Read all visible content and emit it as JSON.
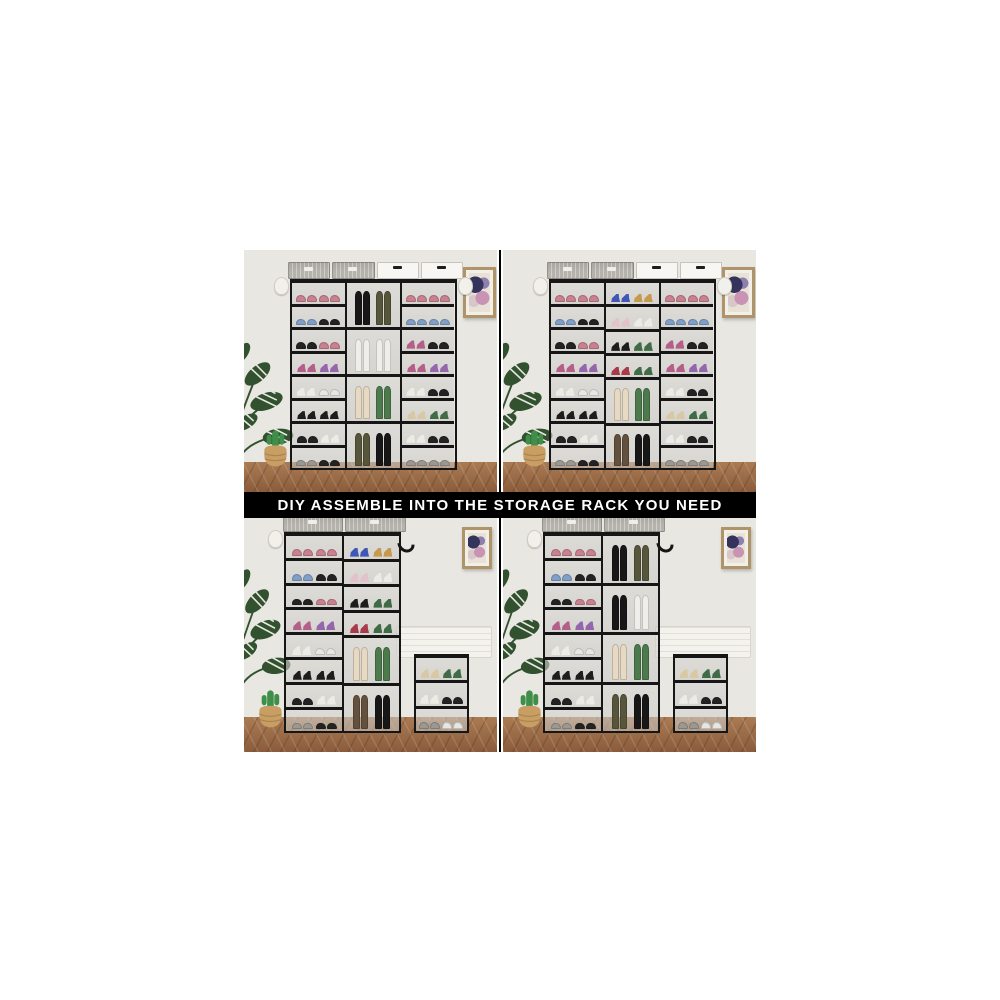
{
  "image": {
    "description": "e-commerce product collage of DIY modular shoe storage racks shown in four room scenes",
    "background": "#ffffff"
  },
  "banner": {
    "text": "DIY ASSEMBLE INTO THE STORAGE RACK YOU NEED",
    "bg": "#000000",
    "color": "#ffffff"
  },
  "colors": {
    "wall": "#e9e7e2",
    "floor_light": "#aa7b53",
    "floor_dark": "#8a5c3c",
    "rack_frame": "#161616",
    "shelf_back": "#cdccc8",
    "basket_gray": "#b6b3ad",
    "basket_white": "#f7f6f2",
    "frame_wood": "#ae9468",
    "bench_white": "#f4f2ed",
    "plant_green": "#31512f",
    "cactus_green": "#3f8f4b",
    "pot_tan": "#c89e62",
    "divider": "#000000"
  },
  "palette": {
    "pk": {
      "type": "sneaker",
      "color": "#c9808f"
    },
    "bl": {
      "type": "sneaker",
      "color": "#7f9fc9"
    },
    "wh": {
      "type": "sneaker",
      "color": "#e6e6e3"
    },
    "gy": {
      "type": "sneaker",
      "color": "#9a9893"
    },
    "bk": {
      "type": "sneaker",
      "color": "#232323"
    },
    "ph": {
      "type": "heel",
      "color": "#9467ad"
    },
    "mh": {
      "type": "heel",
      "color": "#b35f8a"
    },
    "whh": {
      "type": "heel",
      "color": "#edebe6"
    },
    "bh": {
      "type": "heel",
      "color": "#1d1d1d"
    },
    "rh": {
      "type": "heel",
      "color": "#a93a4a"
    },
    "yh": {
      "type": "heel",
      "color": "#c59a4e"
    },
    "blh": {
      "type": "heel",
      "color": "#4157b8"
    },
    "gh": {
      "type": "heel",
      "color": "#3f6b46"
    },
    "pf": {
      "type": "heel",
      "color": "#e2c3c9"
    },
    "th": {
      "type": "heel",
      "color": "#d8c9a4"
    },
    "bb": {
      "type": "boot",
      "color": "#171717"
    },
    "ob": {
      "type": "boot",
      "color": "#57563b"
    },
    "wb": {
      "type": "boot",
      "color": "#efeeea"
    },
    "cb": {
      "type": "boot",
      "color": "#e7d9c2"
    },
    "grb": {
      "type": "boot",
      "color": "#4c7a4c"
    },
    "brb": {
      "type": "boot",
      "color": "#63503d"
    }
  },
  "columns": {
    "sideA": [
      {
        "h": 1,
        "shoes": [
          "pk",
          "pk"
        ]
      },
      {
        "h": 1,
        "shoes": [
          "bl",
          "bk"
        ]
      },
      {
        "h": 1,
        "shoes": [
          "bk",
          "pk"
        ]
      },
      {
        "h": 1,
        "shoes": [
          "mh",
          "ph"
        ]
      },
      {
        "h": 1,
        "shoes": [
          "whh",
          "wh"
        ]
      },
      {
        "h": 1,
        "shoes": [
          "bh",
          "bh"
        ]
      },
      {
        "h": 1,
        "shoes": [
          "bk",
          "whh"
        ]
      },
      {
        "h": 1,
        "shoes": [
          "gy",
          "bk"
        ]
      }
    ],
    "sideB": [
      {
        "h": 1,
        "shoes": [
          "pk",
          "pk"
        ]
      },
      {
        "h": 1,
        "shoes": [
          "bl",
          "bl"
        ]
      },
      {
        "h": 1,
        "shoes": [
          "mh",
          "bk"
        ]
      },
      {
        "h": 1,
        "shoes": [
          "mh",
          "ph"
        ]
      },
      {
        "h": 1,
        "shoes": [
          "whh",
          "bk"
        ]
      },
      {
        "h": 1,
        "shoes": [
          "th",
          "gh"
        ]
      },
      {
        "h": 1,
        "shoes": [
          "whh",
          "bk"
        ]
      },
      {
        "h": 1,
        "shoes": [
          "gy",
          "gy"
        ]
      }
    ],
    "boots4": [
      {
        "h": 2,
        "shoes": [
          "bb",
          "ob"
        ]
      },
      {
        "h": 2,
        "shoes": [
          "wb",
          "wb"
        ]
      },
      {
        "h": 2,
        "shoes": [
          "cb",
          "grb"
        ]
      },
      {
        "h": 2,
        "shoes": [
          "ob",
          "bb"
        ]
      }
    ],
    "boots4b": [
      {
        "h": 2,
        "shoes": [
          "bb",
          "ob"
        ]
      },
      {
        "h": 2,
        "shoes": [
          "bb",
          "wb"
        ]
      },
      {
        "h": 2,
        "shoes": [
          "cb",
          "grb"
        ]
      },
      {
        "h": 2,
        "shoes": [
          "ob",
          "bb"
        ]
      }
    ],
    "mixed": [
      {
        "h": 1,
        "shoes": [
          "blh",
          "yh"
        ]
      },
      {
        "h": 1,
        "shoes": [
          "pf",
          "whh"
        ]
      },
      {
        "h": 1,
        "shoes": [
          "bh",
          "gh"
        ]
      },
      {
        "h": 1,
        "shoes": [
          "rh",
          "gh"
        ]
      },
      {
        "h": 2,
        "shoes": [
          "cb",
          "grb"
        ]
      },
      {
        "h": 2,
        "shoes": [
          "brb",
          "bb"
        ]
      }
    ],
    "smallTiers": [
      {
        "h": 1,
        "shoes": [
          "th",
          "gh"
        ]
      },
      {
        "h": 1,
        "shoes": [
          "whh",
          "bk"
        ]
      },
      {
        "h": 1,
        "shoes": [
          "gy",
          "wh"
        ]
      }
    ]
  },
  "scenes": [
    {
      "name": "scene-top-left",
      "caption": "three-column nine-tier rack with tall boot bay in middle column",
      "floor_pct": 12.5,
      "plant": {
        "left": -8,
        "top": 32,
        "width": 28,
        "height": 62
      },
      "cactus": {
        "left": 6,
        "bottom": 10,
        "width": 13,
        "height": 17
      },
      "frame": {
        "top": 7,
        "right": 0.5,
        "width": 13,
        "height": 21
      },
      "bench": null,
      "racks": [
        {
          "x": 18,
          "w": 66,
          "top": 12,
          "bottom": 9,
          "boxes": [
            "gray",
            "gray",
            "white",
            "white"
          ],
          "hangers": [
            "hat-left",
            "hat-right"
          ],
          "cols": [
            "sideA",
            "boots4",
            "sideB"
          ]
        }
      ]
    },
    {
      "name": "scene-top-right",
      "caption": "three-column rack with shoe shelves on top and boot bays below in middle column",
      "floor_pct": 12.5,
      "plant": {
        "left": -8,
        "top": 32,
        "width": 28,
        "height": 62
      },
      "cactus": {
        "left": 6,
        "bottom": 10,
        "width": 13,
        "height": 17
      },
      "frame": {
        "top": 7,
        "right": 0.5,
        "width": 13,
        "height": 21
      },
      "bench": null,
      "racks": [
        {
          "x": 18,
          "w": 66,
          "top": 12,
          "bottom": 9,
          "boxes": [
            "gray",
            "gray",
            "white",
            "white"
          ],
          "hangers": [
            "hat-left",
            "hat-right"
          ],
          "cols": [
            "sideA",
            "mixed",
            "sideB"
          ]
        }
      ]
    },
    {
      "name": "scene-bottom-left",
      "caption": "two-column tall rack plus separate three-tier small rack and wall bench",
      "floor_pct": 15,
      "plant": {
        "left": -7,
        "top": 15,
        "width": 26,
        "height": 66
      },
      "cactus": {
        "left": 4,
        "bottom": 10,
        "width": 13,
        "height": 18
      },
      "frame": {
        "top": 4,
        "right": 2,
        "width": 12,
        "height": 18
      },
      "bench": {
        "right": 2,
        "width": 38,
        "height": 14,
        "bottom": 40
      },
      "racks": [
        {
          "x": 16,
          "w": 46,
          "top": 6,
          "bottom": 8,
          "boxes": [
            "gray",
            "gray"
          ],
          "hangers": [
            "hat-left",
            "hook-right"
          ],
          "cols": [
            "sideA",
            "mixed"
          ]
        },
        {
          "x": 67,
          "w": 22,
          "top": 58,
          "bottom": 8,
          "boxes": null,
          "hangers": [],
          "cols": [
            "smallTiers"
          ]
        }
      ]
    },
    {
      "name": "scene-bottom-right",
      "caption": "two-column tall rack with boot bays in right column plus three-tier small rack and wall bench",
      "floor_pct": 15,
      "plant": {
        "left": -7,
        "top": 15,
        "width": 26,
        "height": 66
      },
      "cactus": {
        "left": 4,
        "bottom": 10,
        "width": 13,
        "height": 18
      },
      "frame": {
        "top": 4,
        "right": 2,
        "width": 12,
        "height": 18
      },
      "bench": {
        "right": 2,
        "width": 38,
        "height": 14,
        "bottom": 40
      },
      "racks": [
        {
          "x": 16,
          "w": 46,
          "top": 6,
          "bottom": 8,
          "boxes": [
            "gray",
            "gray"
          ],
          "hangers": [
            "hat-left",
            "hook-right"
          ],
          "cols": [
            "sideA",
            "boots4b"
          ]
        },
        {
          "x": 67,
          "w": 22,
          "top": 58,
          "bottom": 8,
          "boxes": null,
          "hangers": [],
          "cols": [
            "smallTiers"
          ]
        }
      ]
    }
  ]
}
